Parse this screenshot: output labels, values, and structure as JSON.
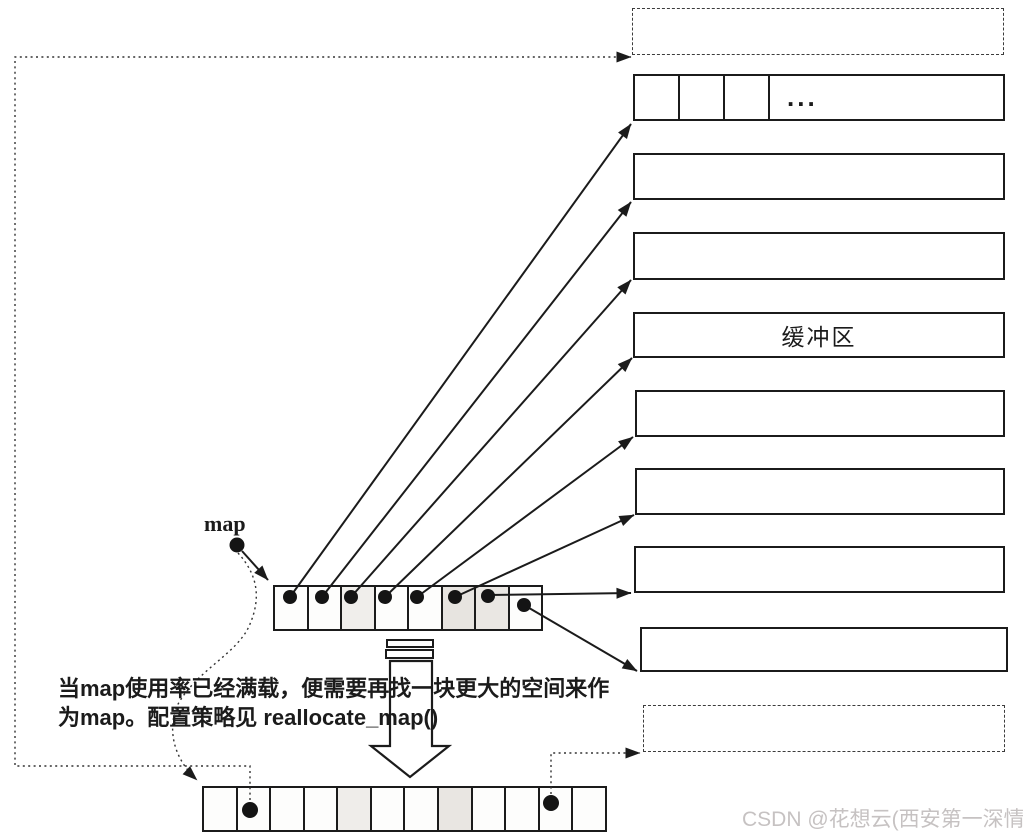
{
  "figure": {
    "labels": {
      "map": "map",
      "buffer": "缓冲区",
      "ellipsis": "...",
      "caption_line1": "当map使用率已经满载，便需要再找一块更大的空间来作",
      "caption_line2": "为map。配置策略见 reallocate_map()"
    },
    "watermark": "CSDN @花想云(西安第一深情)",
    "colors": {
      "ink": "#1b1b1b",
      "watermark": "#c6c2c2",
      "paper": "#ffffff"
    },
    "map_array": {
      "cell_count": 8
    },
    "new_map_array": {
      "cell_count": 12,
      "dot_cell_positions": [
        2,
        11
      ]
    },
    "first_buffer": {
      "small_cell_count": 3
    },
    "buffers": {
      "solid_count": 8,
      "dashed_count": 2
    }
  }
}
